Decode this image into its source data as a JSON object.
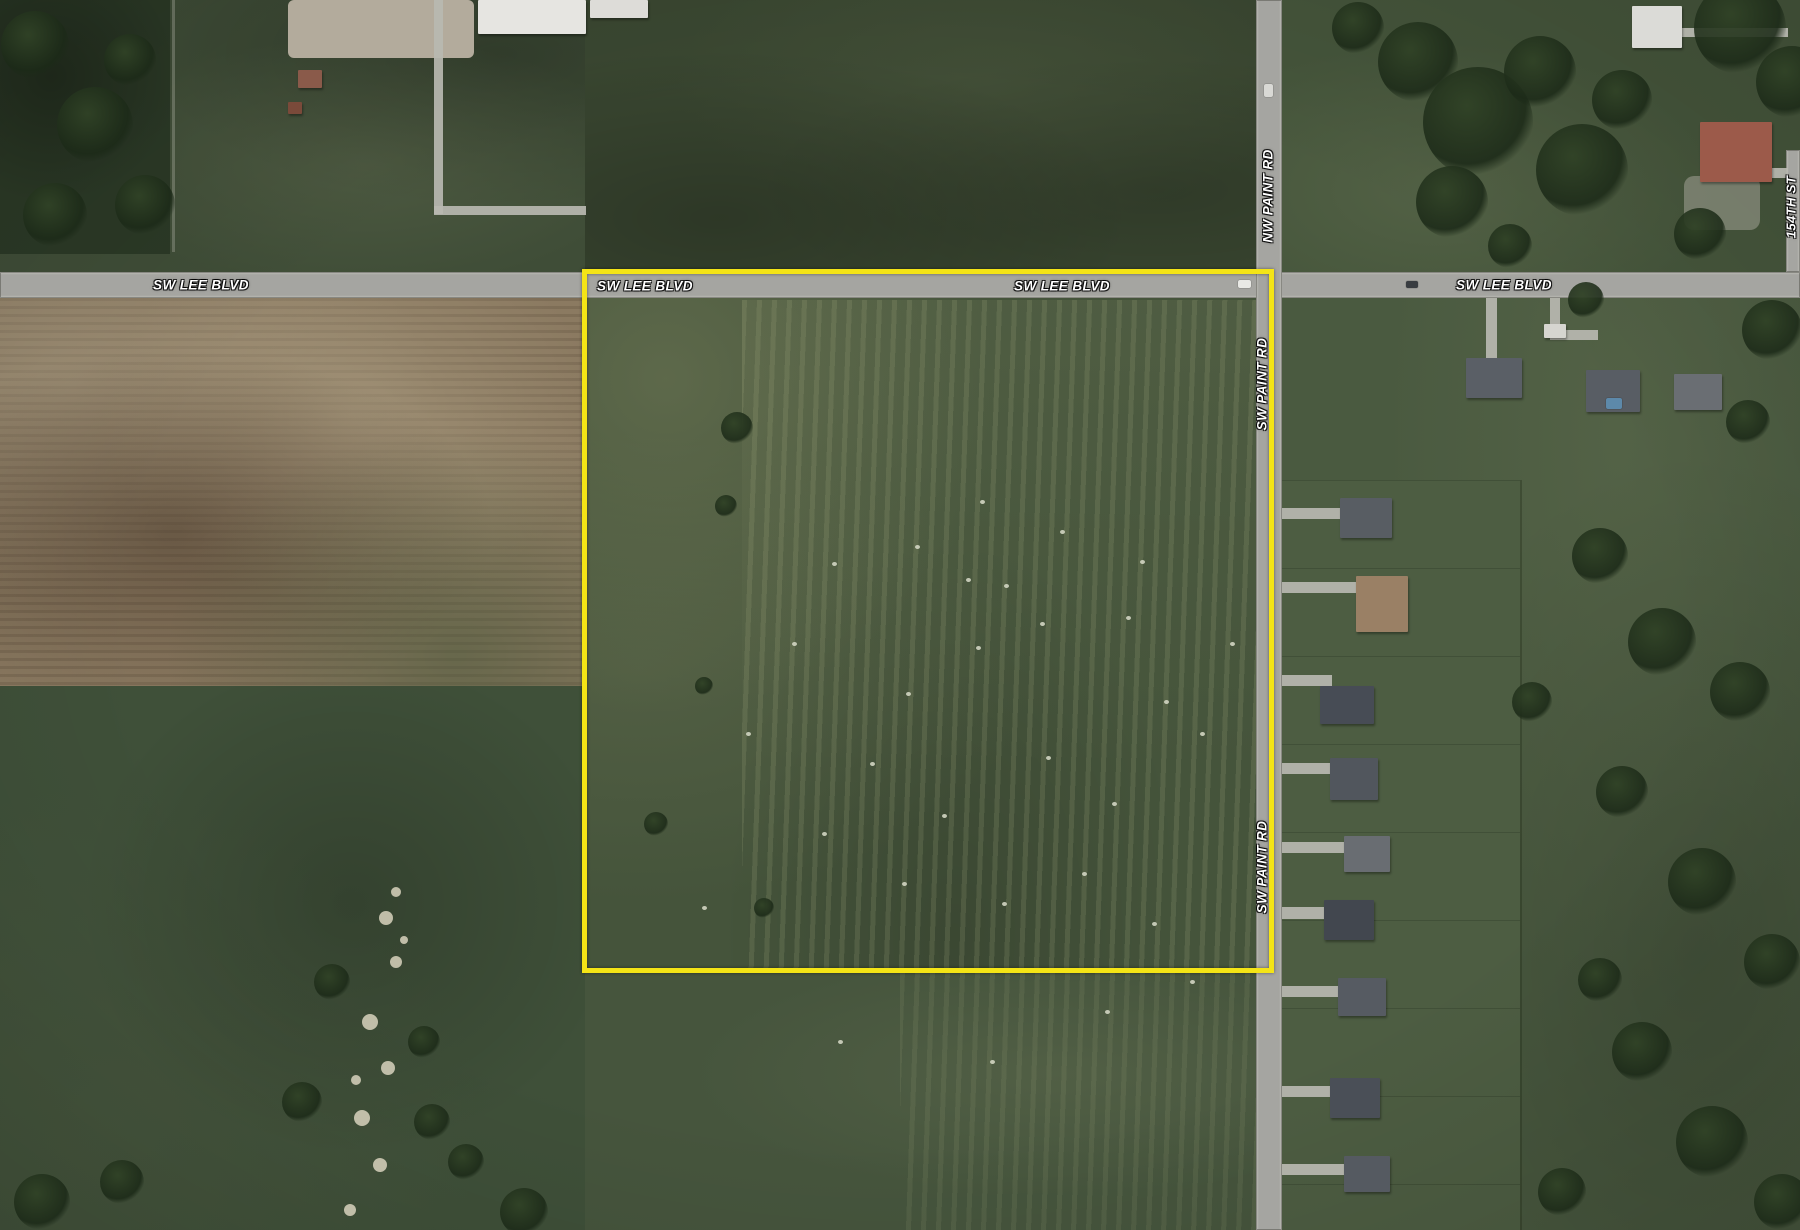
{
  "map": {
    "view": "satellite-aerial",
    "road_labels": {
      "lee": [
        "SW LEE BLVD",
        "SW LEE BLVD",
        "SW LEE BLVD",
        "SW LEE BLVD"
      ],
      "nw_paint": "NW PAINT RD",
      "sw_paint": [
        "SW PAINT RD",
        "SW PAINT RD"
      ],
      "s154th": "154TH ST"
    },
    "colors": {
      "parcel_outline": "#f4e416",
      "road": "#a5a5a1",
      "driveway": "#b9b8b1",
      "label_text": "#ffffff",
      "tan_field": "#8b7a61",
      "pasture": "#45543b",
      "tree": "#243520",
      "creek": "#27321f",
      "sand": "#d8d2bd"
    }
  },
  "features": {
    "houses": [
      [
        1340,
        498,
        52,
        40,
        "#585d63"
      ],
      [
        1356,
        576,
        52,
        56,
        "#9a8065"
      ],
      [
        1320,
        686,
        54,
        38,
        "#474c55"
      ],
      [
        1330,
        758,
        48,
        42,
        "#51565d"
      ],
      [
        1344,
        836,
        46,
        36,
        "#696d72"
      ],
      [
        1324,
        900,
        50,
        40,
        "#42474f"
      ],
      [
        1338,
        978,
        48,
        38,
        "#565b62"
      ],
      [
        1330,
        1078,
        50,
        40,
        "#4a4f57"
      ],
      [
        1344,
        1156,
        46,
        36,
        "#555a61"
      ],
      [
        1466,
        358,
        56,
        40,
        "#5a5f66"
      ],
      [
        1586,
        370,
        54,
        42,
        "#585d64"
      ],
      [
        1674,
        374,
        48,
        36,
        "#6a6e73"
      ],
      [
        1544,
        324,
        22,
        14,
        "#d6d5d0",
        "outbuilding"
      ],
      [
        1700,
        122,
        72,
        60,
        "#9c5a4a",
        "red-roof-house"
      ],
      [
        1632,
        6,
        50,
        42,
        "#dbdbd7",
        "white-roof-house"
      ],
      [
        478,
        0,
        108,
        34,
        "#e6e5e1",
        "industrial-building"
      ],
      [
        590,
        0,
        58,
        18,
        "#dddcd8",
        "industrial-building"
      ],
      [
        298,
        70,
        24,
        18,
        "#8a5a4a",
        "shed"
      ],
      [
        288,
        102,
        14,
        12,
        "#7a4a3a",
        "shed"
      ]
    ],
    "driveways": [
      [
        1282,
        508,
        60,
        11
      ],
      [
        1282,
        582,
        76,
        11
      ],
      [
        1282,
        675,
        50,
        11
      ],
      [
        1282,
        763,
        50,
        11
      ],
      [
        1282,
        842,
        64,
        11
      ],
      [
        1282,
        907,
        54,
        12
      ],
      [
        1282,
        986,
        58,
        11
      ],
      [
        1282,
        1086,
        50,
        11
      ],
      [
        1282,
        1164,
        64,
        11
      ],
      [
        1486,
        298,
        11,
        62
      ],
      [
        1550,
        298,
        10,
        40
      ],
      [
        1550,
        330,
        48,
        10
      ],
      [
        1724,
        168,
        64,
        10
      ],
      [
        1680,
        28,
        108,
        9
      ],
      [
        434,
        0,
        9,
        214
      ],
      [
        434,
        206,
        152,
        9
      ]
    ],
    "pads": [
      [
        1684,
        176,
        76,
        54,
        "rgba(185,180,170,.45)",
        10
      ],
      [
        288,
        0,
        186,
        58,
        "#b3ab9c",
        6
      ]
    ],
    "trees": [
      [
        35,
        45,
        34
      ],
      [
        95,
        125,
        38
      ],
      [
        145,
        205,
        30
      ],
      [
        55,
        215,
        32
      ],
      [
        130,
        60,
        26
      ],
      [
        1358,
        28,
        26
      ],
      [
        1418,
        62,
        40
      ],
      [
        1478,
        122,
        55
      ],
      [
        1540,
        72,
        36
      ],
      [
        1582,
        170,
        46
      ],
      [
        1622,
        100,
        30
      ],
      [
        1452,
        202,
        36
      ],
      [
        1740,
        28,
        46
      ],
      [
        1792,
        82,
        36
      ],
      [
        1700,
        234,
        26
      ],
      [
        1510,
        246,
        22
      ],
      [
        1772,
        330,
        30
      ],
      [
        1748,
        422,
        22
      ],
      [
        1586,
        300,
        18
      ],
      [
        1600,
        556,
        28
      ],
      [
        1662,
        642,
        34
      ],
      [
        1740,
        692,
        30
      ],
      [
        1622,
        792,
        26
      ],
      [
        1702,
        882,
        34
      ],
      [
        1772,
        962,
        28
      ],
      [
        1642,
        1052,
        30
      ],
      [
        1712,
        1142,
        36
      ],
      [
        1782,
        1202,
        28
      ],
      [
        1562,
        1192,
        24
      ],
      [
        1532,
        702,
        20
      ],
      [
        1600,
        980,
        22
      ],
      [
        332,
        982,
        18
      ],
      [
        424,
        1042,
        16
      ],
      [
        302,
        1102,
        20
      ],
      [
        432,
        1122,
        18
      ],
      [
        42,
        1202,
        28
      ],
      [
        122,
        1182,
        22
      ],
      [
        524,
        1212,
        24
      ],
      [
        466,
        1162,
        18
      ],
      [
        737,
        428,
        16
      ],
      [
        726,
        506,
        11
      ],
      [
        656,
        824,
        12
      ],
      [
        704,
        686,
        9
      ],
      [
        764,
        908,
        10
      ]
    ],
    "hay_dots": [
      [
        966,
        578
      ],
      [
        1004,
        584
      ],
      [
        1040,
        622
      ],
      [
        1126,
        616
      ],
      [
        1164,
        700
      ],
      [
        976,
        646
      ],
      [
        906,
        692
      ],
      [
        1046,
        756
      ],
      [
        1112,
        802
      ],
      [
        942,
        814
      ],
      [
        870,
        762
      ],
      [
        1200,
        732
      ],
      [
        1230,
        642
      ],
      [
        832,
        562
      ],
      [
        792,
        642
      ],
      [
        746,
        732
      ],
      [
        822,
        832
      ],
      [
        902,
        882
      ],
      [
        1002,
        902
      ],
      [
        1082,
        872
      ],
      [
        1152,
        922
      ],
      [
        702,
        906
      ],
      [
        1060,
        530
      ],
      [
        1140,
        560
      ],
      [
        980,
        500
      ],
      [
        915,
        545
      ],
      [
        1190,
        980
      ],
      [
        1105,
        1010
      ],
      [
        990,
        1060
      ],
      [
        838,
        1040
      ]
    ],
    "objects": [
      [
        1238,
        280,
        13,
        8,
        "#e9e9e5",
        "vehicle"
      ],
      [
        1406,
        281,
        12,
        7,
        "#393d41",
        "vehicle"
      ],
      [
        1264,
        84,
        9,
        13,
        "#d9d9d5",
        "vehicle"
      ],
      [
        1606,
        398,
        16,
        11,
        "#5d89aa",
        "swimming-pool"
      ]
    ],
    "sand": [
      [
        386,
        918,
        7
      ],
      [
        396,
        962,
        6
      ],
      [
        370,
        1022,
        8
      ],
      [
        388,
        1068,
        7
      ],
      [
        362,
        1118,
        8
      ],
      [
        380,
        1165,
        7
      ],
      [
        396,
        892,
        5
      ],
      [
        350,
        1210,
        6
      ],
      [
        404,
        940,
        4
      ],
      [
        356,
        1080,
        5
      ]
    ],
    "lines": [
      [
        1520,
        480,
        2,
        750,
        "rgba(25,35,18,.30)"
      ],
      [
        172,
        0,
        3,
        252,
        "rgba(205,205,195,.28)"
      ]
    ]
  }
}
